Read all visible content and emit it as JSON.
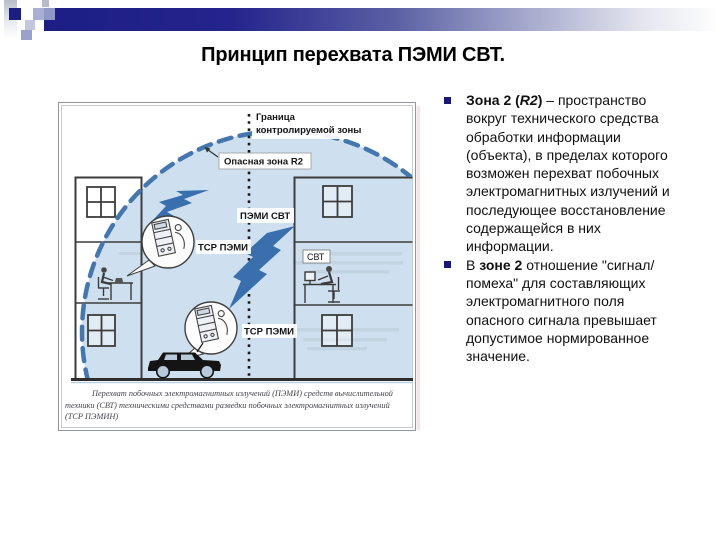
{
  "slide": {
    "title": "Принцип перехвата ПЭМИ СВТ."
  },
  "colors": {
    "accent_navy": "#1d1d86",
    "bullet_square": "#17177e",
    "zone_fill": "#aecbe4",
    "zone_dash": "#4476af",
    "emission_bolt": "#3a6fad"
  },
  "bullets": {
    "item1": {
      "bold1": "Зона 2 (",
      "bold_italic": "R2",
      "bold2": ") ",
      "normal": "– пространство вокруг технического средства обработки информации (объекта), в пределах которого возможен перехват побочных электромагнитных излучений и последующее восстановление содержащейся в них информации."
    },
    "item2": {
      "normal1": "В ",
      "bold1": "зоне 2",
      "normal2": " отношение \"сигнал/помеха\" для составляющих электромагнитного поля опасного сигнала превышает допустимое нормированное значение."
    }
  },
  "diagram": {
    "boundary_label": {
      "line1": "Граница",
      "line2": "контролируемой зоны"
    },
    "danger_zone_label": "Опасная зона R2",
    "pemi_svt_label": "ПЭМИ СВТ",
    "tsr_pemi_upper_label": "ТСР ПЭМИ",
    "tsr_pemi_lower_label": "ТСР ПЭМИ",
    "svt_label": "СВТ",
    "caption": {
      "line1": "Перехват побочных электромагнитных излучений (ПЭМИ) средств вычислительной",
      "line2": "техники (СВТ) техническими средствами разведки побочных электромагнитных излучений",
      "line3": "(ТСР ПЭМИН)"
    }
  }
}
